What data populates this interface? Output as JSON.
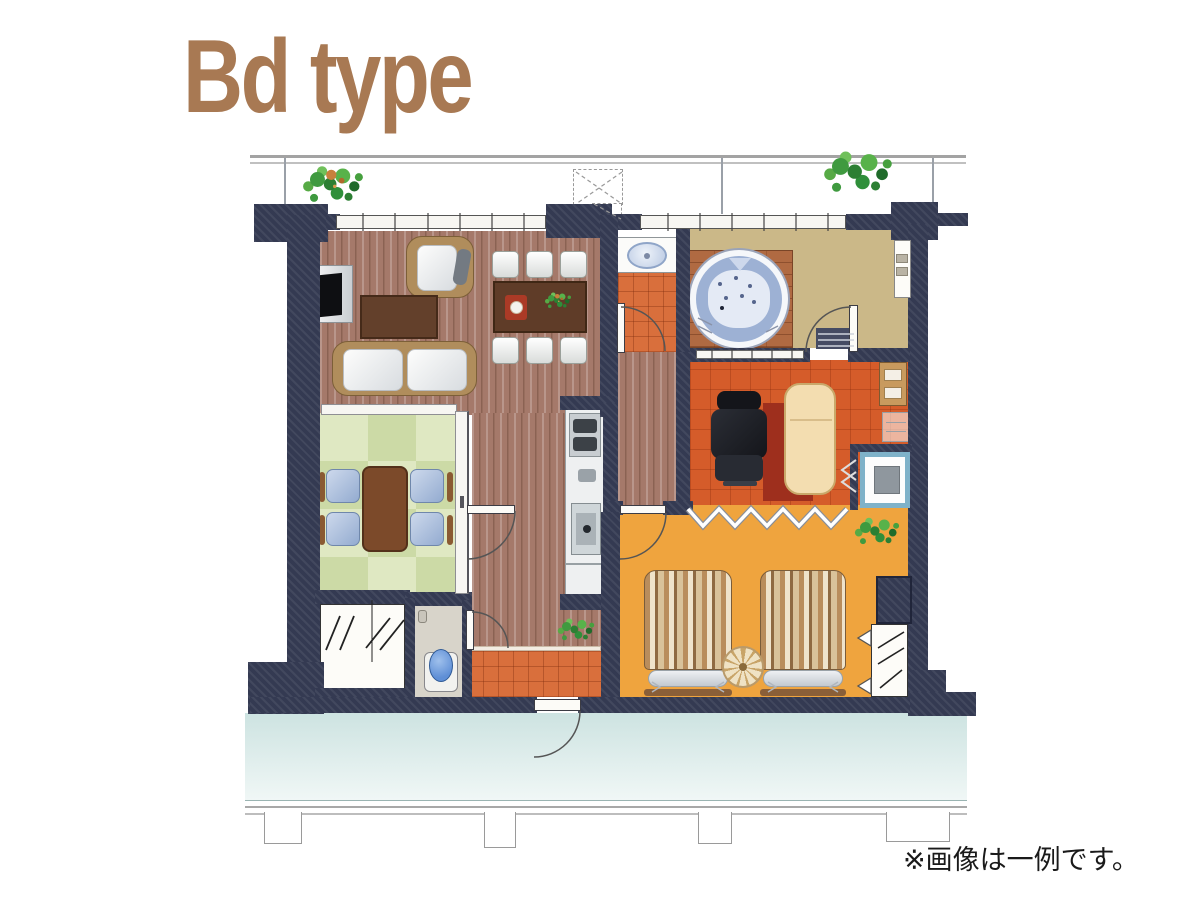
{
  "title": "Bd type",
  "caption": "※画像は一例です。",
  "colors": {
    "titleBrown": "#a87953",
    "captionBlack": "#1a1a1a",
    "wall": "#343a52",
    "woodFloor": "#a5796a",
    "tatamiLight": "#dfe8c2",
    "tatamiDark": "#ccdaa6",
    "tileOrange": "#d96f3c",
    "roomOrange": "#d55c2a",
    "bedroomAmber": "#efa43e",
    "bathTan": "#cbb888",
    "deckBrick": "#b06a42",
    "tubBlue": "#9db1d4",
    "tubWater": "#e4eaf5",
    "corridorBlue": "#cde3e1",
    "tableBrown": "#5f3c28",
    "sofaTan": "#b08d5c",
    "chairBlue": "#a3b8d8",
    "loungerCream": "#f3ddb0",
    "matRed": "#9e2f1d",
    "applianceBlue": "#7fb2c9",
    "toiletBlue": "#5f8fd6"
  }
}
